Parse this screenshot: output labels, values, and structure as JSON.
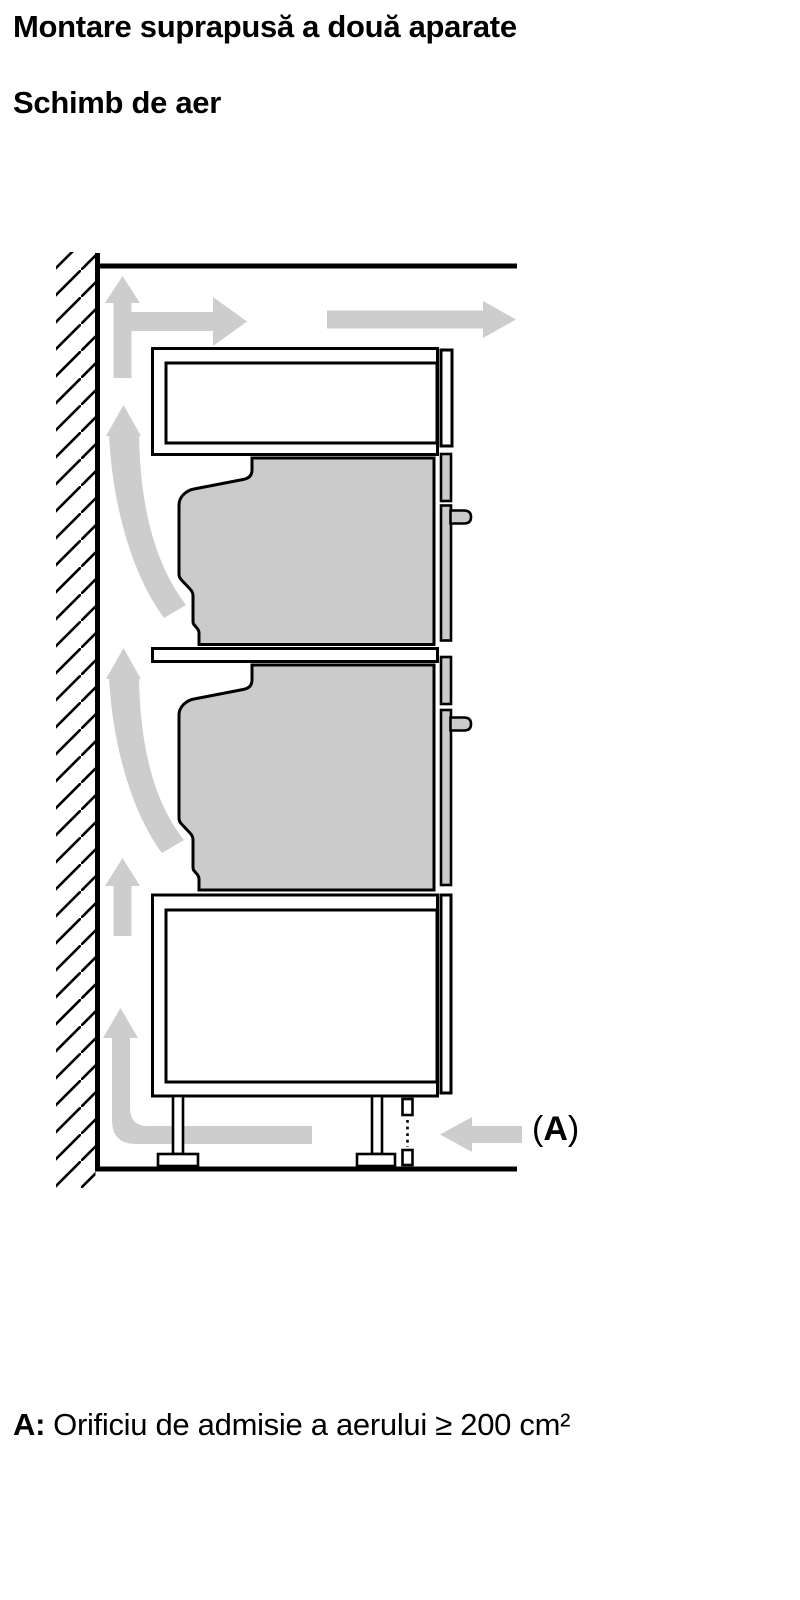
{
  "page": {
    "title_line1": "Montare suprapusă a două aparate",
    "title_line2": "Schimb de aer",
    "footer": {
      "label": "A:",
      "text": "Orificiu de admisie a aerului ≥ 200 cm²"
    }
  },
  "diagram": {
    "callout": {
      "open": "(",
      "letter": "A",
      "close": ")"
    },
    "colors": {
      "appliance_fill": "#cbcbcb",
      "arrow_fill": "#cdcdcd",
      "panel_fill": "#ffffff",
      "outline": "#000000"
    },
    "icons": [
      "wall-hatching",
      "airflow-up-arrow-icon",
      "airflow-right-arrow-icon",
      "airflow-curved-arrow-icon",
      "airflow-left-arrow-icon",
      "air-inlet-vent-dashed-marker"
    ]
  }
}
